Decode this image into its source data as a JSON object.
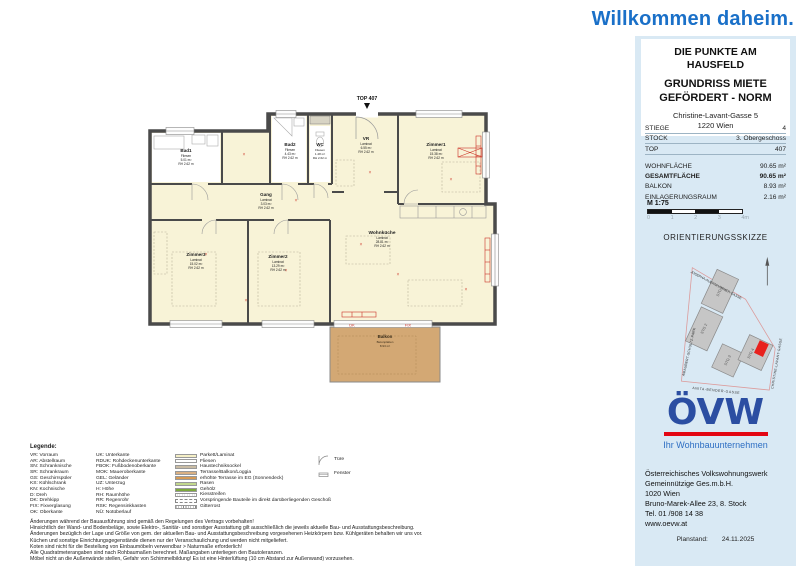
{
  "colors": {
    "welcome_blue": "#1a70c8",
    "brand_blue": "#2b4ea2",
    "accent_red": "#e30613",
    "panel_blue": "#d9e9f4",
    "floor_yellow": "#f8f3d7",
    "balcony_tan": "#d3a874",
    "unit_marker_red": "#e8211d"
  },
  "header": {
    "welcome": "Willkommen daheim."
  },
  "sidebar": {
    "project_line1": "DIE PUNKTE AM HAUSFELD",
    "project_line2": "GRUNDRISS MIETE GEFÖRDERT - NORM",
    "address_line1": "Christine-Lavant-Gasse 5",
    "address_line2": "1220 Wien",
    "info": [
      {
        "label": "STIEGE",
        "value": "4"
      },
      {
        "label": "STOCK",
        "value": "3. Obergeschoss"
      },
      {
        "label": "TOP",
        "value": "407"
      }
    ],
    "areas": [
      {
        "label": "WOHNFLÄCHE",
        "value": "90.65 m²"
      },
      {
        "label": "GESAMTFLÄCHE",
        "value": "90.65 m²"
      },
      {
        "label": "BALKON",
        "value": "8.93 m²"
      },
      {
        "label": "EINLAGERUNGSRAUM",
        "value": "2.16 m²"
      }
    ],
    "scale": {
      "label": "M 1:75",
      "ticks": [
        "0",
        "1",
        "2",
        "3",
        "4m"
      ]
    },
    "sketch": {
      "title": "ORIENTIERUNGSSKIZZE",
      "street_top": "JOSEPHA-AUERNHAMMER-GASSE",
      "street_left": "AMAUBERT-SCHULTZ-PARK",
      "street_bottom": "ANITA-BENDER-GASSE",
      "street_right": "CHRISTINE-LAVANT-GASSE",
      "buildings": [
        "STG 1",
        "STG 2",
        "STG 3",
        "STG 4"
      ]
    },
    "logo": {
      "text": "ÖVW",
      "tagline": "Ihr Wohnbauunternehmen"
    },
    "company": [
      "Österreichisches Volkswohnungswerk",
      "Gemeinnützige Ges.m.b.H.",
      "1020 Wien",
      "Bruno-Marek-Allee 23, 8. Stock",
      "Tel. 01 /908 14 38",
      "www.oevw.at"
    ],
    "planstand_label": "Planstand:",
    "planstand_date": "24.11.2025"
  },
  "plan": {
    "top_label": "TOP 407",
    "window_label_left": "DK",
    "window_label_right": "FIX",
    "rooms": {
      "bad1": {
        "name": "Bad1",
        "floor": "Fliesen",
        "area": "5.01 m²",
        "rh": "RH 2.62 m"
      },
      "bad2": {
        "name": "Bad2",
        "floor": "Fliesen",
        "area": "4.43 m²",
        "rh": "RH 2.62 m"
      },
      "wc": {
        "name": "WC",
        "floor": "Fliesen",
        "area": "1.48 m²",
        "rh": "RH 2.62 m"
      },
      "vr": {
        "name": "VR",
        "floor": "Laminat",
        "area": "6.55 m²",
        "rh": "RH 2.62 m"
      },
      "gang": {
        "name": "Gang",
        "floor": "Laminat",
        "area": "3.03 m²",
        "rh": "RH 2.62 m"
      },
      "zimmer1": {
        "name": "Zimmer1",
        "floor": "Laminat",
        "area": "15.38 m²",
        "rh": "RH 2.62 m"
      },
      "zimmer2": {
        "name": "Zimmer2",
        "floor": "Laminat",
        "area": "13.29 m²",
        "rh": "RH 2.62 m"
      },
      "zimmer3": {
        "name": "Zimmer3",
        "floor": "Laminat",
        "area": "15.02 m²",
        "rh": "RH 2.62 m"
      },
      "wohnkueche": {
        "name": "Wohnküche",
        "floor": "Laminat",
        "area": "28.81 m²",
        "rh": "RH 2.62 m"
      },
      "balkon": {
        "name": "Balkon",
        "floor": "Betonplatten",
        "area": "8.93 m²"
      }
    }
  },
  "legend": {
    "title": "Legende:",
    "col1": [
      "VR: Vorraum",
      "AR: Abstellraum",
      "SN: Schranknische",
      "SR: Schrankraum",
      "GS: Geschirrspüler",
      "KS: Kühlschrank",
      "KN: Kochnische",
      "D: Dreh",
      "DK: Drehkipp",
      "FIX: Fixverglasung",
      "OK: Oberkante"
    ],
    "col2": [
      "UK: Unterkante",
      "RDUK: Rohdeckenunterkante",
      "FBOK: Fußbodenoberkante",
      "MOK: Maueroberkante",
      "GEL: Geländer",
      "UZ: Unterzug",
      "H: Höhe",
      "RH: Raumhöhe",
      "RR: Regenrohr",
      "RSK: Regensinkkasten",
      "NÜ: Notüberlauf"
    ],
    "col3": [
      "Parkett/Laminat",
      "Fliesen",
      "Haustechniksockel",
      "Terrasse/Balkon/Loggia",
      "erhöhte Terrasse im EG (Sonnendeck)",
      "Rasen",
      "Gehölz",
      "Kiesstreifen",
      "Vorspringende Bauteile im direkt darüberliegenden Geschoß",
      "Gitterrost"
    ],
    "col4": [
      "Türe",
      "Fenster"
    ]
  },
  "disclaimer": [
    "Änderungen während der Bauausführung sind gemäß den Regelungen des Vertrags vorbehalten!",
    "Hinsichtlich der Wand- und Bodenbeläge, sowie Elektro-, Sanitär- und sonstiger Ausstattung gilt ausschließlich die jeweils aktuelle Bau- und Ausstattungsbeschreibung.",
    "Änderungen bezüglich der Lage und Größe von gem. der aktuellen Bau- und Ausstattungsbeschreibung vorgesehenen Heizkörpern bzw. Kühlgeräten behalten wir uns vor.",
    "Küchen und sonstige Einrichtungsgegenstände dienen nur der Veranschaulichung und werden nicht mitgeliefert.",
    "Koten sind nicht für die Bestellung von Einbaumöbeln verwendbar > Naturmaße erforderlich!",
    "Alle Quadratmeterangaben sind nach Rohbaumaßen berechnet. Maßangaben unterliegen den Bautoleranzen.",
    "Möbel nicht an die Außenwände stellen, Gefahr von Schimmelbildung! Es ist eine Hinterlüftung (10 cm Abstand zur Außenwand) vorzusehen."
  ]
}
